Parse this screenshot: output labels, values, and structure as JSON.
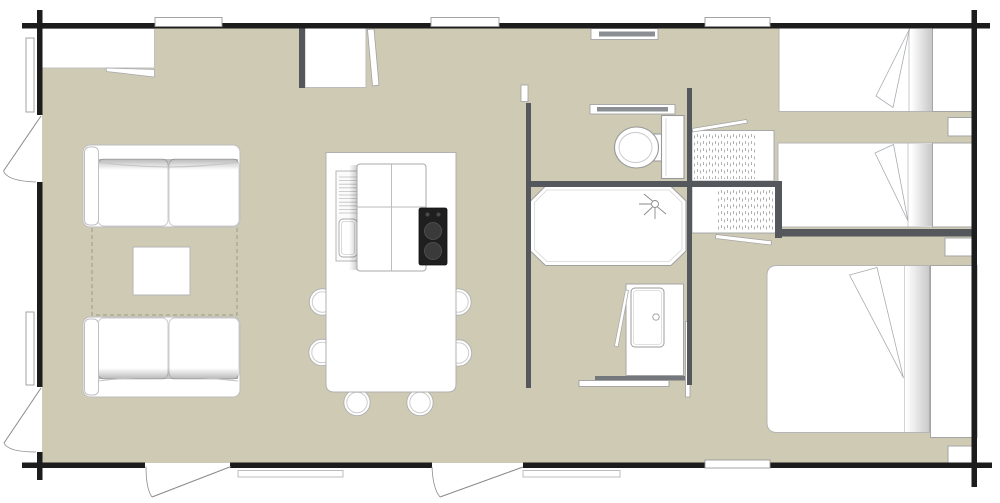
{
  "meta": {
    "view": "floor-plan",
    "description": "Top-down architectural floor plan of a mobile home / holiday lodge with living area, island kitchen, bathroom with shower and WC, twin bedroom and double bedroom"
  },
  "colors": {
    "background": "#ffffff",
    "floor": "#cecab4",
    "exterior_wall": "#1c1c1c",
    "interior_wall": "#54585c",
    "rail_gray": "#74787c",
    "shelf_core": "#8b8f93",
    "furniture_fill": "#ffffff",
    "furniture_stroke": "#b0b0b0",
    "fixture_stroke": "#9a9a9a",
    "cooktop_black": "#1f1f1f",
    "burner_gray": "#3a3a3a",
    "rug_dash": "#9a9e86",
    "fold_line": "#a8adb2"
  },
  "legend": {
    "areas": [
      "living-area",
      "kitchen-dining",
      "hallway",
      "bathroom",
      "wc-area",
      "twin-bedroom",
      "double-bedroom"
    ],
    "furniture": [
      "sofa-top",
      "sofa-bottom",
      "coffee-table",
      "rug",
      "sideboard",
      "tall-cabinet",
      "kitchen-island",
      "kitchen-sink",
      "sink-drainer",
      "cooktop-two-burners",
      "dining-chair",
      "toilet",
      "shower-tray",
      "shower-head-symbol",
      "washbasin-vanity",
      "wardrobe-upper",
      "wardrobe-lower",
      "twin-bed-1",
      "twin-bed-2",
      "double-bed",
      "nightstand",
      "headboard-shelf"
    ],
    "openings": [
      "entrance-door",
      "terrace-door",
      "left-door-top",
      "left-door-bottom",
      "sliding-door",
      "window",
      "outside-step"
    ],
    "counts": {
      "windows": 6,
      "hinged_doors": 4,
      "sliding_doors": 1,
      "dining_chairs": 6,
      "beds": 3,
      "nightstands": 3,
      "steps": 2
    }
  }
}
